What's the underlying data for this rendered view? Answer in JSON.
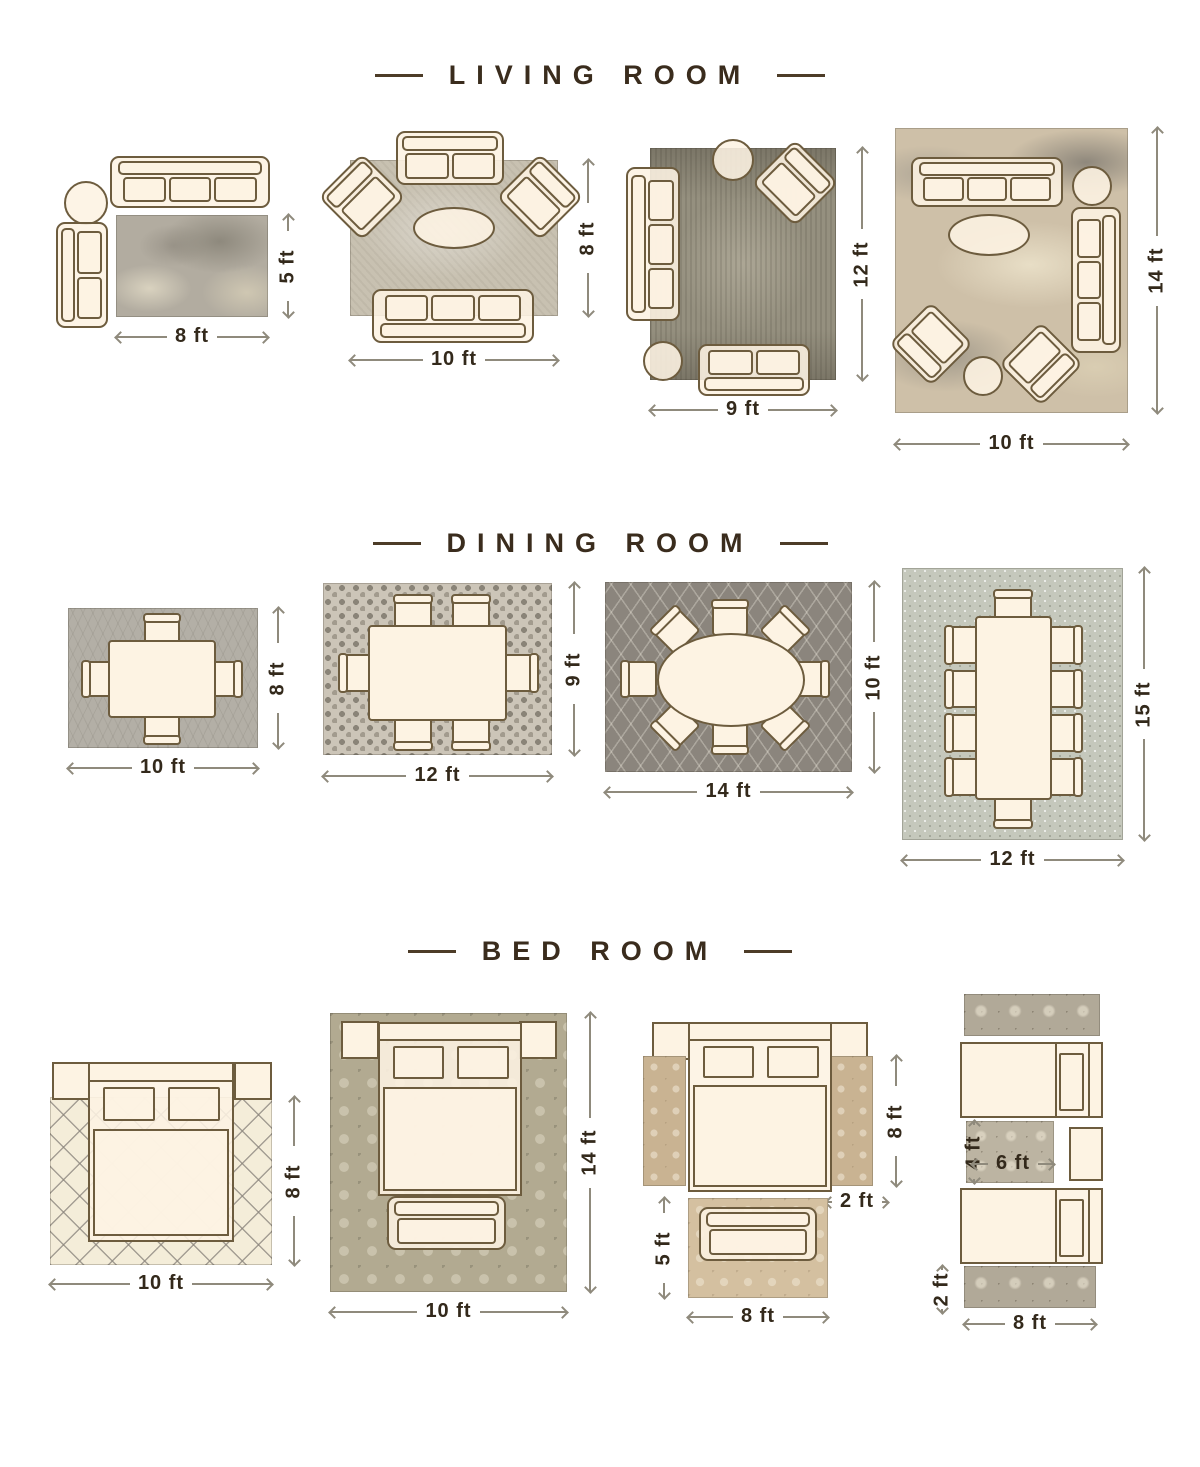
{
  "colors": {
    "furniture_outline": "#6d5c3e",
    "furniture_fill": "#fdf3e3",
    "title_text": "#3a2c1d",
    "dimension_text": "#33291b",
    "dimension_line": "#8f8a7c"
  },
  "sections": {
    "living": {
      "title": "LIVING ROOM",
      "layouts": [
        {
          "width_label": "8 ft",
          "height_label": "5 ft"
        },
        {
          "width_label": "10 ft",
          "height_label": "8 ft"
        },
        {
          "width_label": "9 ft",
          "height_label": "12 ft"
        },
        {
          "width_label": "10 ft",
          "height_label": "14 ft"
        }
      ]
    },
    "dining": {
      "title": "DINING ROOM",
      "layouts": [
        {
          "width_label": "10 ft",
          "height_label": "8 ft"
        },
        {
          "width_label": "12 ft",
          "height_label": "9 ft"
        },
        {
          "width_label": "14 ft",
          "height_label": "10 ft"
        },
        {
          "width_label": "12 ft",
          "height_label": "15 ft"
        }
      ]
    },
    "bedroom": {
      "title": "BED ROOM",
      "layouts": [
        {
          "width_label": "10 ft",
          "height_label": "8 ft"
        },
        {
          "width_label": "10 ft",
          "height_label": "14 ft"
        },
        {
          "runner_height_label": "8 ft",
          "runner_width_label": "2 ft",
          "foot_rug_height_label": "5 ft",
          "foot_rug_width_label": "8 ft"
        },
        {
          "mid_rug_height_label": "4 ft",
          "mid_rug_width_label": "6 ft",
          "runner_width_label": "2 ft",
          "runner_length_label": "8 ft"
        }
      ]
    }
  }
}
